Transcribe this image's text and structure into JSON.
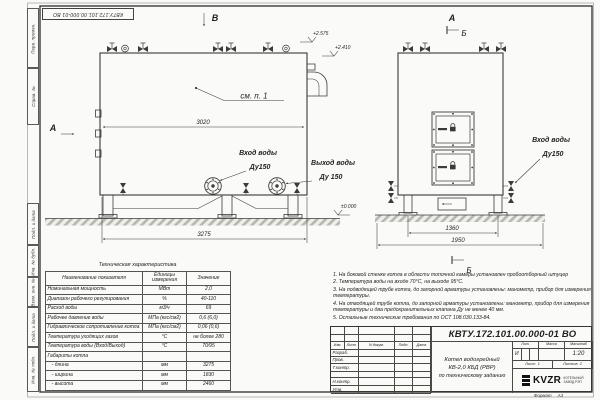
{
  "frame": {
    "designation_inverted": "КВТУ.172.101.00.000-01 ВО",
    "margin_labels": [
      "Перв. примен.",
      "Справ. №",
      "Подп. и дата",
      "Инв. № дубл.",
      "Взам. инв. №",
      "Подп. и дата",
      "Инв. № подл."
    ],
    "format_label": "Формат",
    "format_value": "А3"
  },
  "views": {
    "side": {
      "view_label_top": "В",
      "view_label_left": "А",
      "callout_note": "см. п. 1",
      "dim_top": "3020",
      "dim_bottom": "3275",
      "elev_top": "+2.575",
      "elev_mid": "+2.410",
      "elev_ground": "±0.000",
      "inlet_line1": "Вход воды",
      "inlet_line2": "Ду150",
      "outlet_line1": "Выход воды",
      "outlet_line2": "Ду 150"
    },
    "front": {
      "view_label_top": "А",
      "section_label": "Б",
      "dim_legs": "1360",
      "dim_base": "1950",
      "inlet_line1": "Вход воды",
      "inlet_line2": "Ду150"
    }
  },
  "tech_table": {
    "title": "Техническая характеристика",
    "headers": [
      "Наименование показателя",
      "Единицы измерения",
      "Значение"
    ],
    "rows": [
      [
        "Номинальная мощность",
        "МВт",
        "2,0"
      ],
      [
        "Диапазон рабочего регулирования",
        "%",
        "40-110"
      ],
      [
        "Расход воды",
        "м3/ч",
        "69"
      ],
      [
        "Рабочее давление воды",
        "МПа (кгс/см2)",
        "0,6 (6,0)"
      ],
      [
        "Гидравлическое сопротивление котла",
        "МПа (кгс/см2)",
        "0,06 (0,6)"
      ],
      [
        "Температура уходящих газов",
        "°С",
        "не более 280"
      ],
      [
        "Температура воды (Вход/Выход)",
        "°С",
        "70/95"
      ],
      [
        "Габариты котла",
        "",
        ""
      ],
      [
        "   - длина",
        "мм",
        "3275"
      ],
      [
        "   - ширина",
        "мм",
        "1830"
      ],
      [
        "   - высота",
        "мм",
        "2460"
      ]
    ]
  },
  "notes": {
    "items": [
      "1.  На боковой стенке котла в области топочной камеры установлен пробоотборный штуцер",
      "2.  Температура воды на входе 70°С, на выходе 95°С.",
      "3.  На подводящей трубе котла, до запорной арматуры установлены: манометр, прибор для измерения температуры.",
      "4.  На отводящей трубе котла, до запорной арматуры установлены: манометр, прибор для измерения температуры и два предохранительных клапана Ду не менее 40 мм.",
      "5.  Остальные технические требования по ОСТ 108.030.133-84."
    ]
  },
  "title_block": {
    "designation": "КВТУ.172.101.00.000-01 ВО",
    "doc_name_line1": "Котел водогрейный",
    "doc_name_line2": "КВ-2,0 КБД (РВР)",
    "doc_name_line3": "по техническому заданию",
    "sig_headers": [
      "Изм.",
      "Лист",
      "N докум.",
      "Подп.",
      "Дата"
    ],
    "sig_rows": [
      "Разраб.",
      "Пров.",
      "Т.контр.",
      "",
      "Н.контр.",
      "Утв."
    ],
    "lit_header": "Лит.",
    "mass_header": "Масса",
    "scale_header": "Масштаб",
    "lit_value": "И",
    "scale_value": "1:20",
    "sheet_label": "Лист",
    "sheet_value": "1",
    "sheets_label": "Листов",
    "sheets_value": "2",
    "logo_text": "KVZR",
    "logo_sub1": "КОТЕЛЬНЫЙ",
    "logo_sub2": "ЗАВОД РЭП"
  }
}
